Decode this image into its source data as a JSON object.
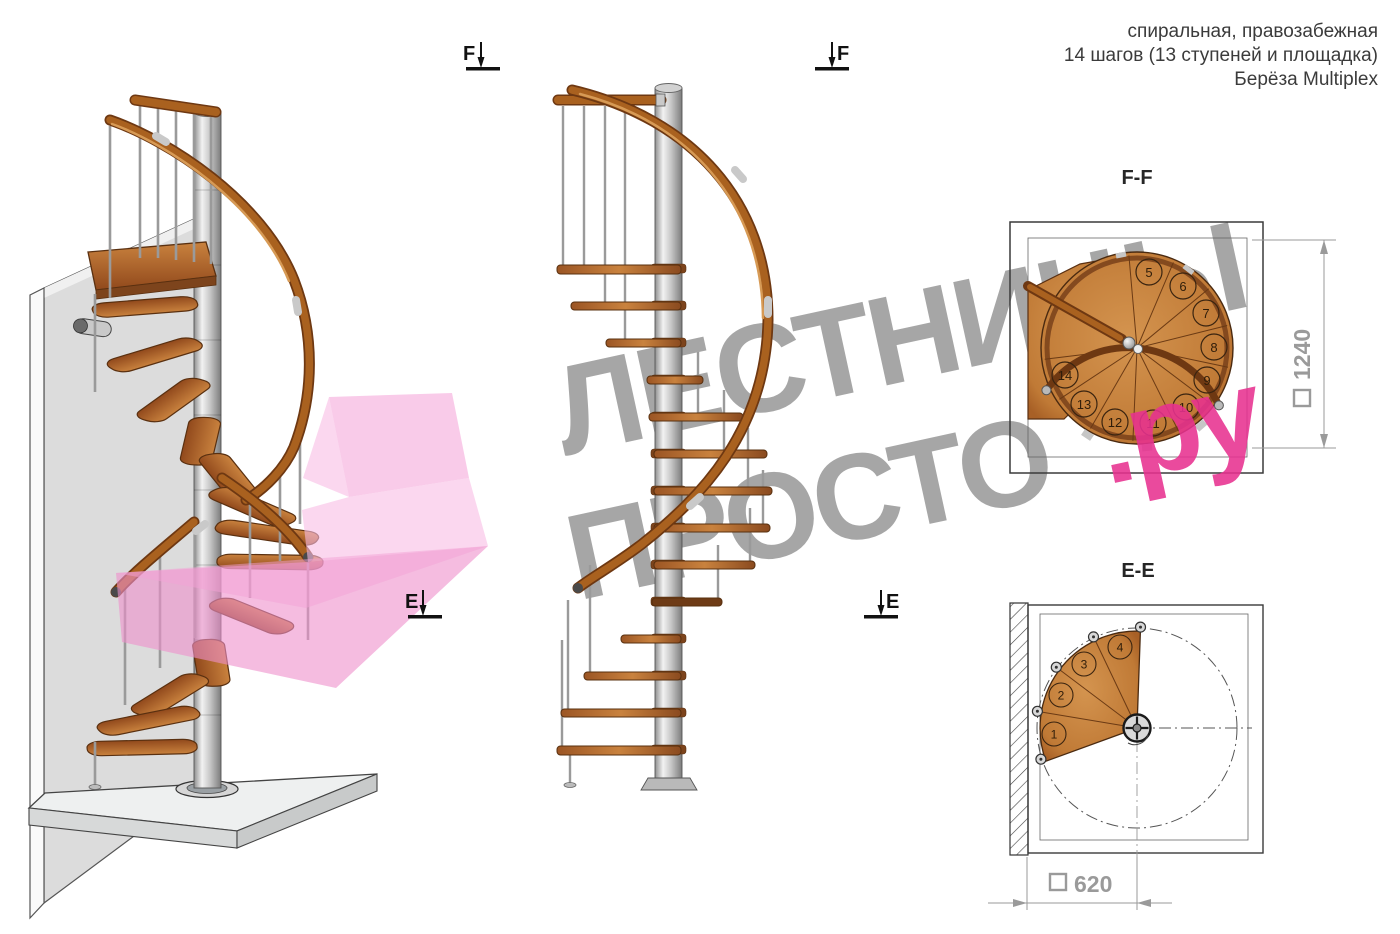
{
  "header": {
    "line1": "спиральная, правозабежная",
    "line2": "14 шагов (13 ступеней и площадка)",
    "line3": "Берёза Multiplex"
  },
  "watermark": {
    "line1": "ЛЕСТНИЦЫ",
    "line2_gray": "ПРОСТО",
    "line2_pink": ".ру",
    "gray_color": "#9a9a9a",
    "pink_color": "#e7318f"
  },
  "sections": {
    "ff": {
      "title": "F-F",
      "dimension": "1240",
      "steps": [
        "5",
        "6",
        "7",
        "8",
        "9",
        "10",
        "11",
        "12",
        "13",
        "14"
      ]
    },
    "ee": {
      "title": "E-E",
      "dimension": "620",
      "steps": [
        "1",
        "2",
        "3",
        "4"
      ]
    }
  },
  "markers": {
    "f": "F",
    "e": "E"
  },
  "colors": {
    "wood": "#b5702f",
    "wood_dark": "#6e3812",
    "metal": "#c2c2c2",
    "wall": "#dcdcdc",
    "line": "#3a3a3a",
    "dim_gray": "#9a9a9a",
    "accent_pink": "#e7318f",
    "logo_pink": "#f2a0d6"
  }
}
